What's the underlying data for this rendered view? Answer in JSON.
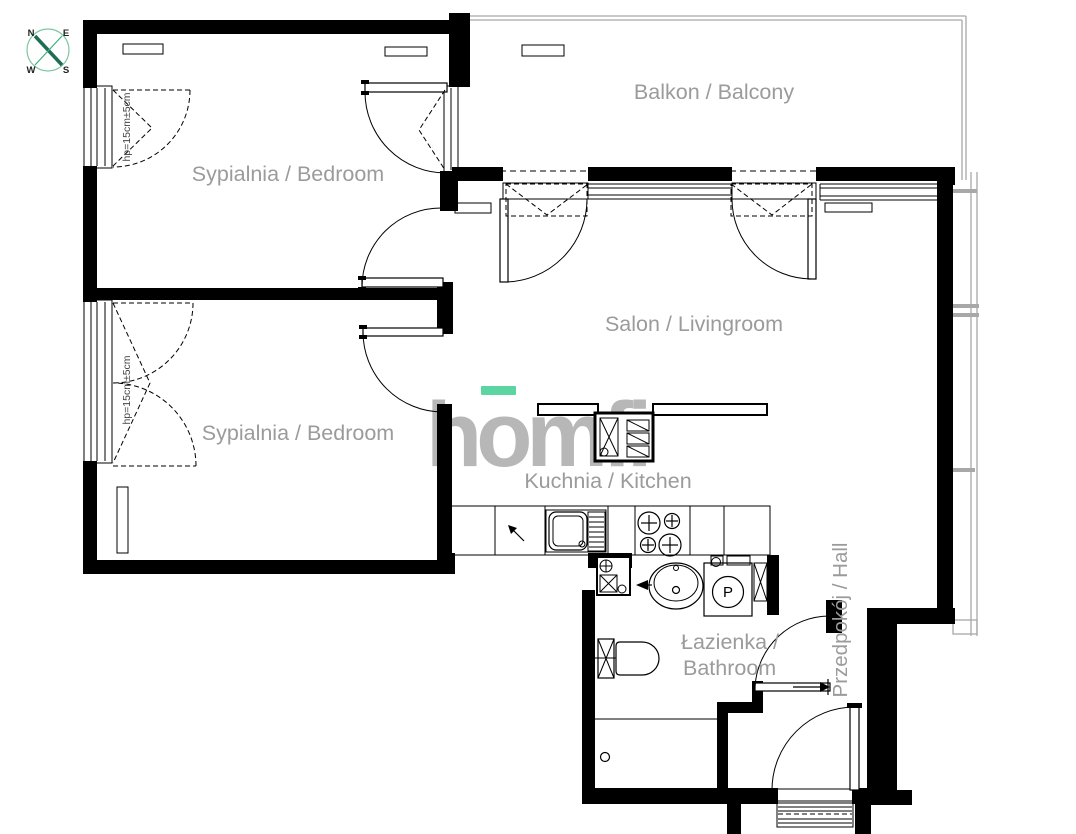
{
  "title": "Apartment floor plan",
  "compass": {
    "n": "N",
    "e": "E",
    "s": "S",
    "w": "W"
  },
  "watermark": {
    "text": "homfi",
    "text_color": "#b7b7b7",
    "accent_color": "#5bd6a2"
  },
  "rooms": {
    "balcony": "Balkon / Balcony",
    "bedroom1": "Sypialnia / Bedroom",
    "bedroom2": "Sypialnia / Bedroom",
    "livingroom": "Salon / Livingroom",
    "kitchen": "Kuchnia / Kitchen",
    "bathroom_line1": "Łazienka /",
    "bathroom_line2": "Bathroom",
    "hall": "Przedpokój / Hall"
  },
  "annotations": {
    "window_sill_1": "hp=15cm±5cm",
    "window_sill_2": "hp=15cm±5cm",
    "washer_label": "P"
  },
  "colors": {
    "wall": "#000000",
    "label": "#9b9b9b",
    "railing": "#a8a8a8",
    "compass_green": "#3fae7c"
  }
}
